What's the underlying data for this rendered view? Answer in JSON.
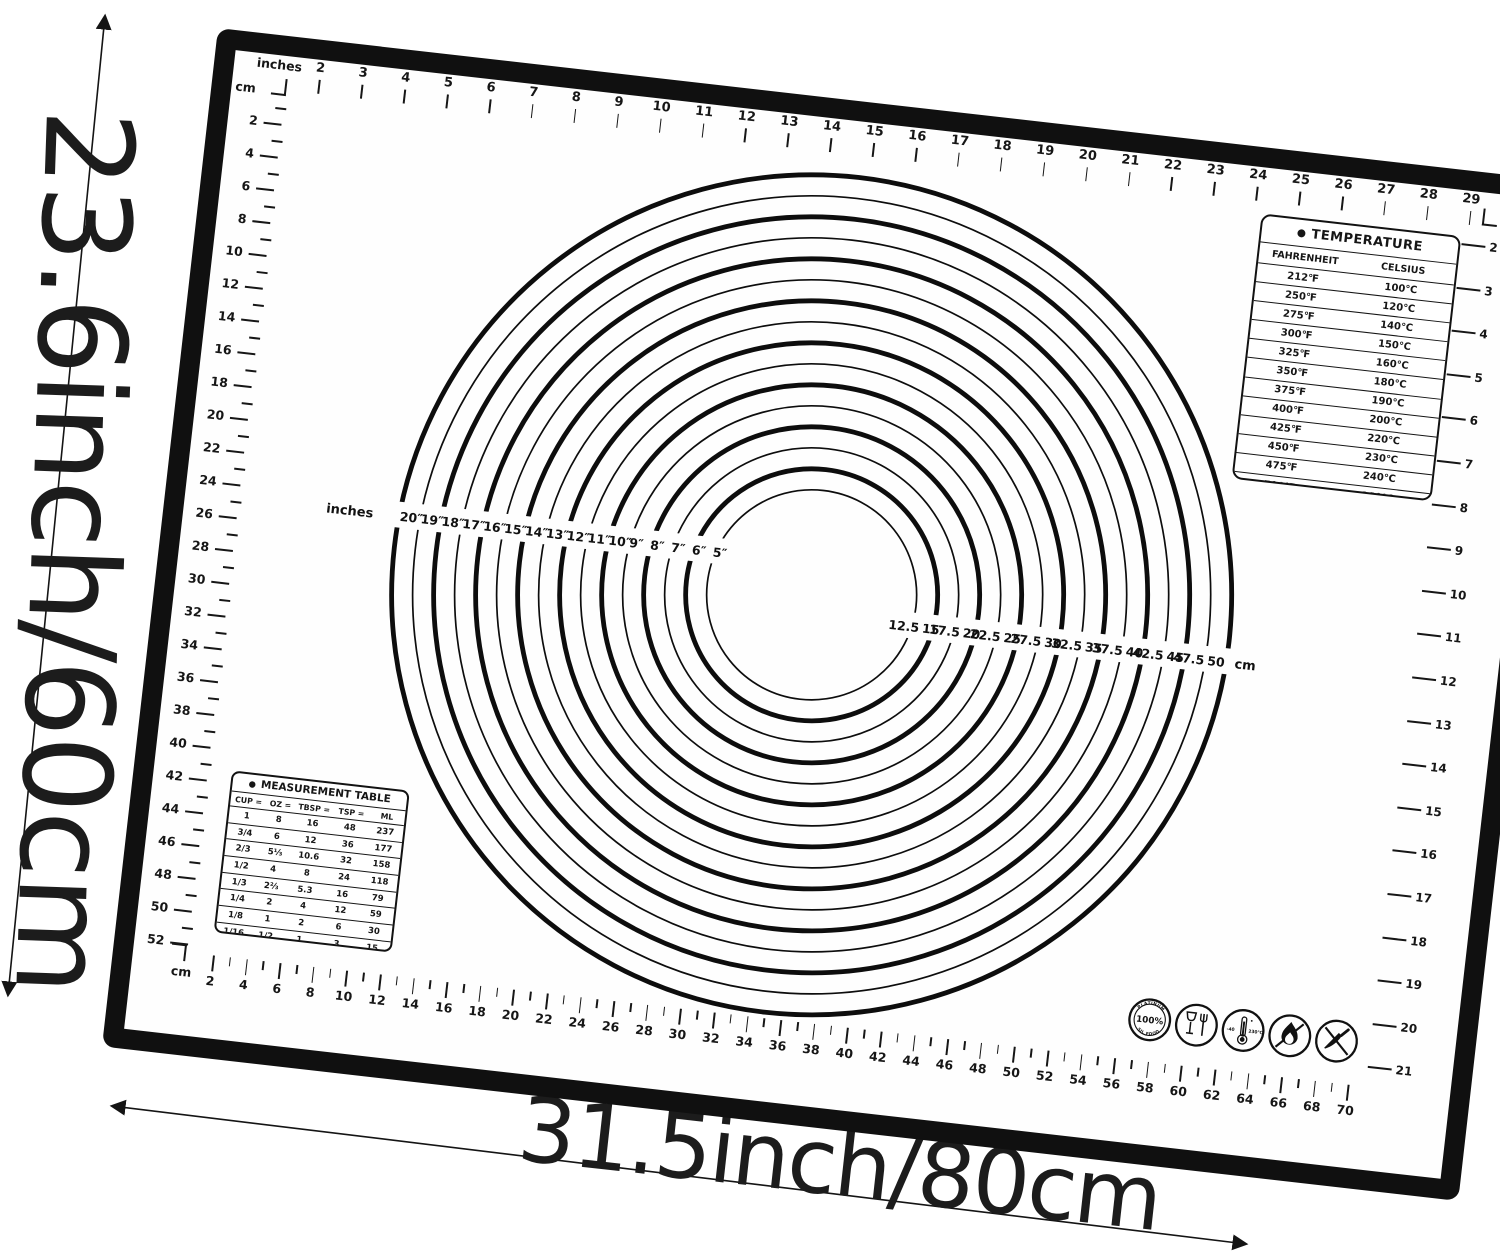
{
  "mat": {
    "border_color": "#101010",
    "bg": "#fefefe",
    "ink": "#161616"
  },
  "dimension_labels": {
    "height": "23.6inch/60cm",
    "width": "31.5inch/80cm"
  },
  "corners": {
    "top_left_unit_top": "inches",
    "top_left_unit_side": "cm",
    "top_right_unit": "inch",
    "bottom_left_unit": "cm"
  },
  "rulers": {
    "top_inches": [
      2,
      3,
      4,
      5,
      6,
      7,
      8,
      9,
      10,
      11,
      12,
      13,
      14,
      15,
      16,
      17,
      18,
      19,
      20,
      21,
      22,
      23,
      24,
      25,
      26,
      27,
      28,
      29
    ],
    "left_cm": [
      2,
      4,
      6,
      8,
      10,
      12,
      14,
      16,
      18,
      20,
      22,
      24,
      26,
      28,
      30,
      32,
      34,
      36,
      38,
      40,
      42,
      44,
      46,
      48,
      50,
      52
    ],
    "right_inches": [
      2,
      3,
      4,
      5,
      6,
      7,
      8,
      9,
      10,
      11,
      12,
      13,
      14,
      15,
      16,
      17,
      18,
      19,
      20,
      21
    ],
    "bottom_cm": [
      2,
      4,
      6,
      8,
      10,
      12,
      14,
      16,
      18,
      20,
      22,
      24,
      26,
      28,
      30,
      32,
      34,
      36,
      38,
      40,
      42,
      44,
      46,
      48,
      50,
      52,
      54,
      56,
      58,
      60,
      62,
      64,
      66,
      68,
      70
    ]
  },
  "circle_gauge": {
    "ring_color": "#0d0d0d",
    "left_axis_label": "inches",
    "right_axis_label": "cm",
    "inch_diameters": [
      20,
      19,
      18,
      17,
      16,
      15,
      14,
      13,
      12,
      11,
      10,
      9,
      8,
      7,
      6,
      5
    ],
    "inch_labels": [
      "20″",
      "19″",
      "18″",
      "17″",
      "16″",
      "15″",
      "14″",
      "13″",
      "12″",
      "11″",
      "10″",
      "9″",
      "8″",
      "7″",
      "6″",
      "5″"
    ],
    "cm_values": [
      12.5,
      15,
      17.5,
      20,
      22.5,
      25,
      27.5,
      30,
      32.5,
      35,
      37.5,
      40,
      42.5,
      45,
      47.5,
      50
    ],
    "cm_labels": [
      "12.5",
      "15",
      "17.5",
      "20",
      "22.5",
      "25",
      "27.5",
      "30",
      "32.5",
      "35",
      "37.5",
      "40",
      "42.5",
      "45",
      "47.5",
      "50"
    ]
  },
  "temperature_table": {
    "bullet": "●",
    "title": "TEMPERATURE",
    "columns": [
      "FAHRENHEIT",
      "CELSIUS"
    ],
    "rows": [
      [
        "212℉",
        "100℃"
      ],
      [
        "250℉",
        "120℃"
      ],
      [
        "275℉",
        "140℃"
      ],
      [
        "300℉",
        "150℃"
      ],
      [
        "325℉",
        "160℃"
      ],
      [
        "350℉",
        "180℃"
      ],
      [
        "375℉",
        "190℃"
      ],
      [
        "400℉",
        "200℃"
      ],
      [
        "425℉",
        "220℃"
      ],
      [
        "450℉",
        "230℃"
      ],
      [
        "475℉",
        "240℃"
      ],
      [
        "500℉",
        "260℃"
      ]
    ]
  },
  "measurement_table": {
    "bullet": "●",
    "title": "MEASUREMENT TABLE",
    "header": [
      "CUP =",
      "OZ =",
      "TBSP =",
      "TSP =",
      "ML"
    ],
    "rows": [
      [
        "1",
        "8",
        "16",
        "48",
        "237"
      ],
      [
        "3/4",
        "6",
        "12",
        "36",
        "177"
      ],
      [
        "2/3",
        "5⅓",
        "10.6",
        "32",
        "158"
      ],
      [
        "1/2",
        "4",
        "8",
        "24",
        "118"
      ],
      [
        "1/3",
        "2⅔",
        "5.3",
        "16",
        "79"
      ],
      [
        "1/4",
        "2",
        "4",
        "12",
        "59"
      ],
      [
        "1/8",
        "1",
        "2",
        "6",
        "30"
      ],
      [
        "1/16",
        "1/2",
        "1",
        "3",
        "15"
      ]
    ]
  },
  "badges": {
    "platinum": {
      "top": "PLATINUM",
      "center": "100%",
      "bottom": "SIL FOOD"
    },
    "temp_range": {
      "left": "-40",
      "right": "230℃"
    }
  }
}
